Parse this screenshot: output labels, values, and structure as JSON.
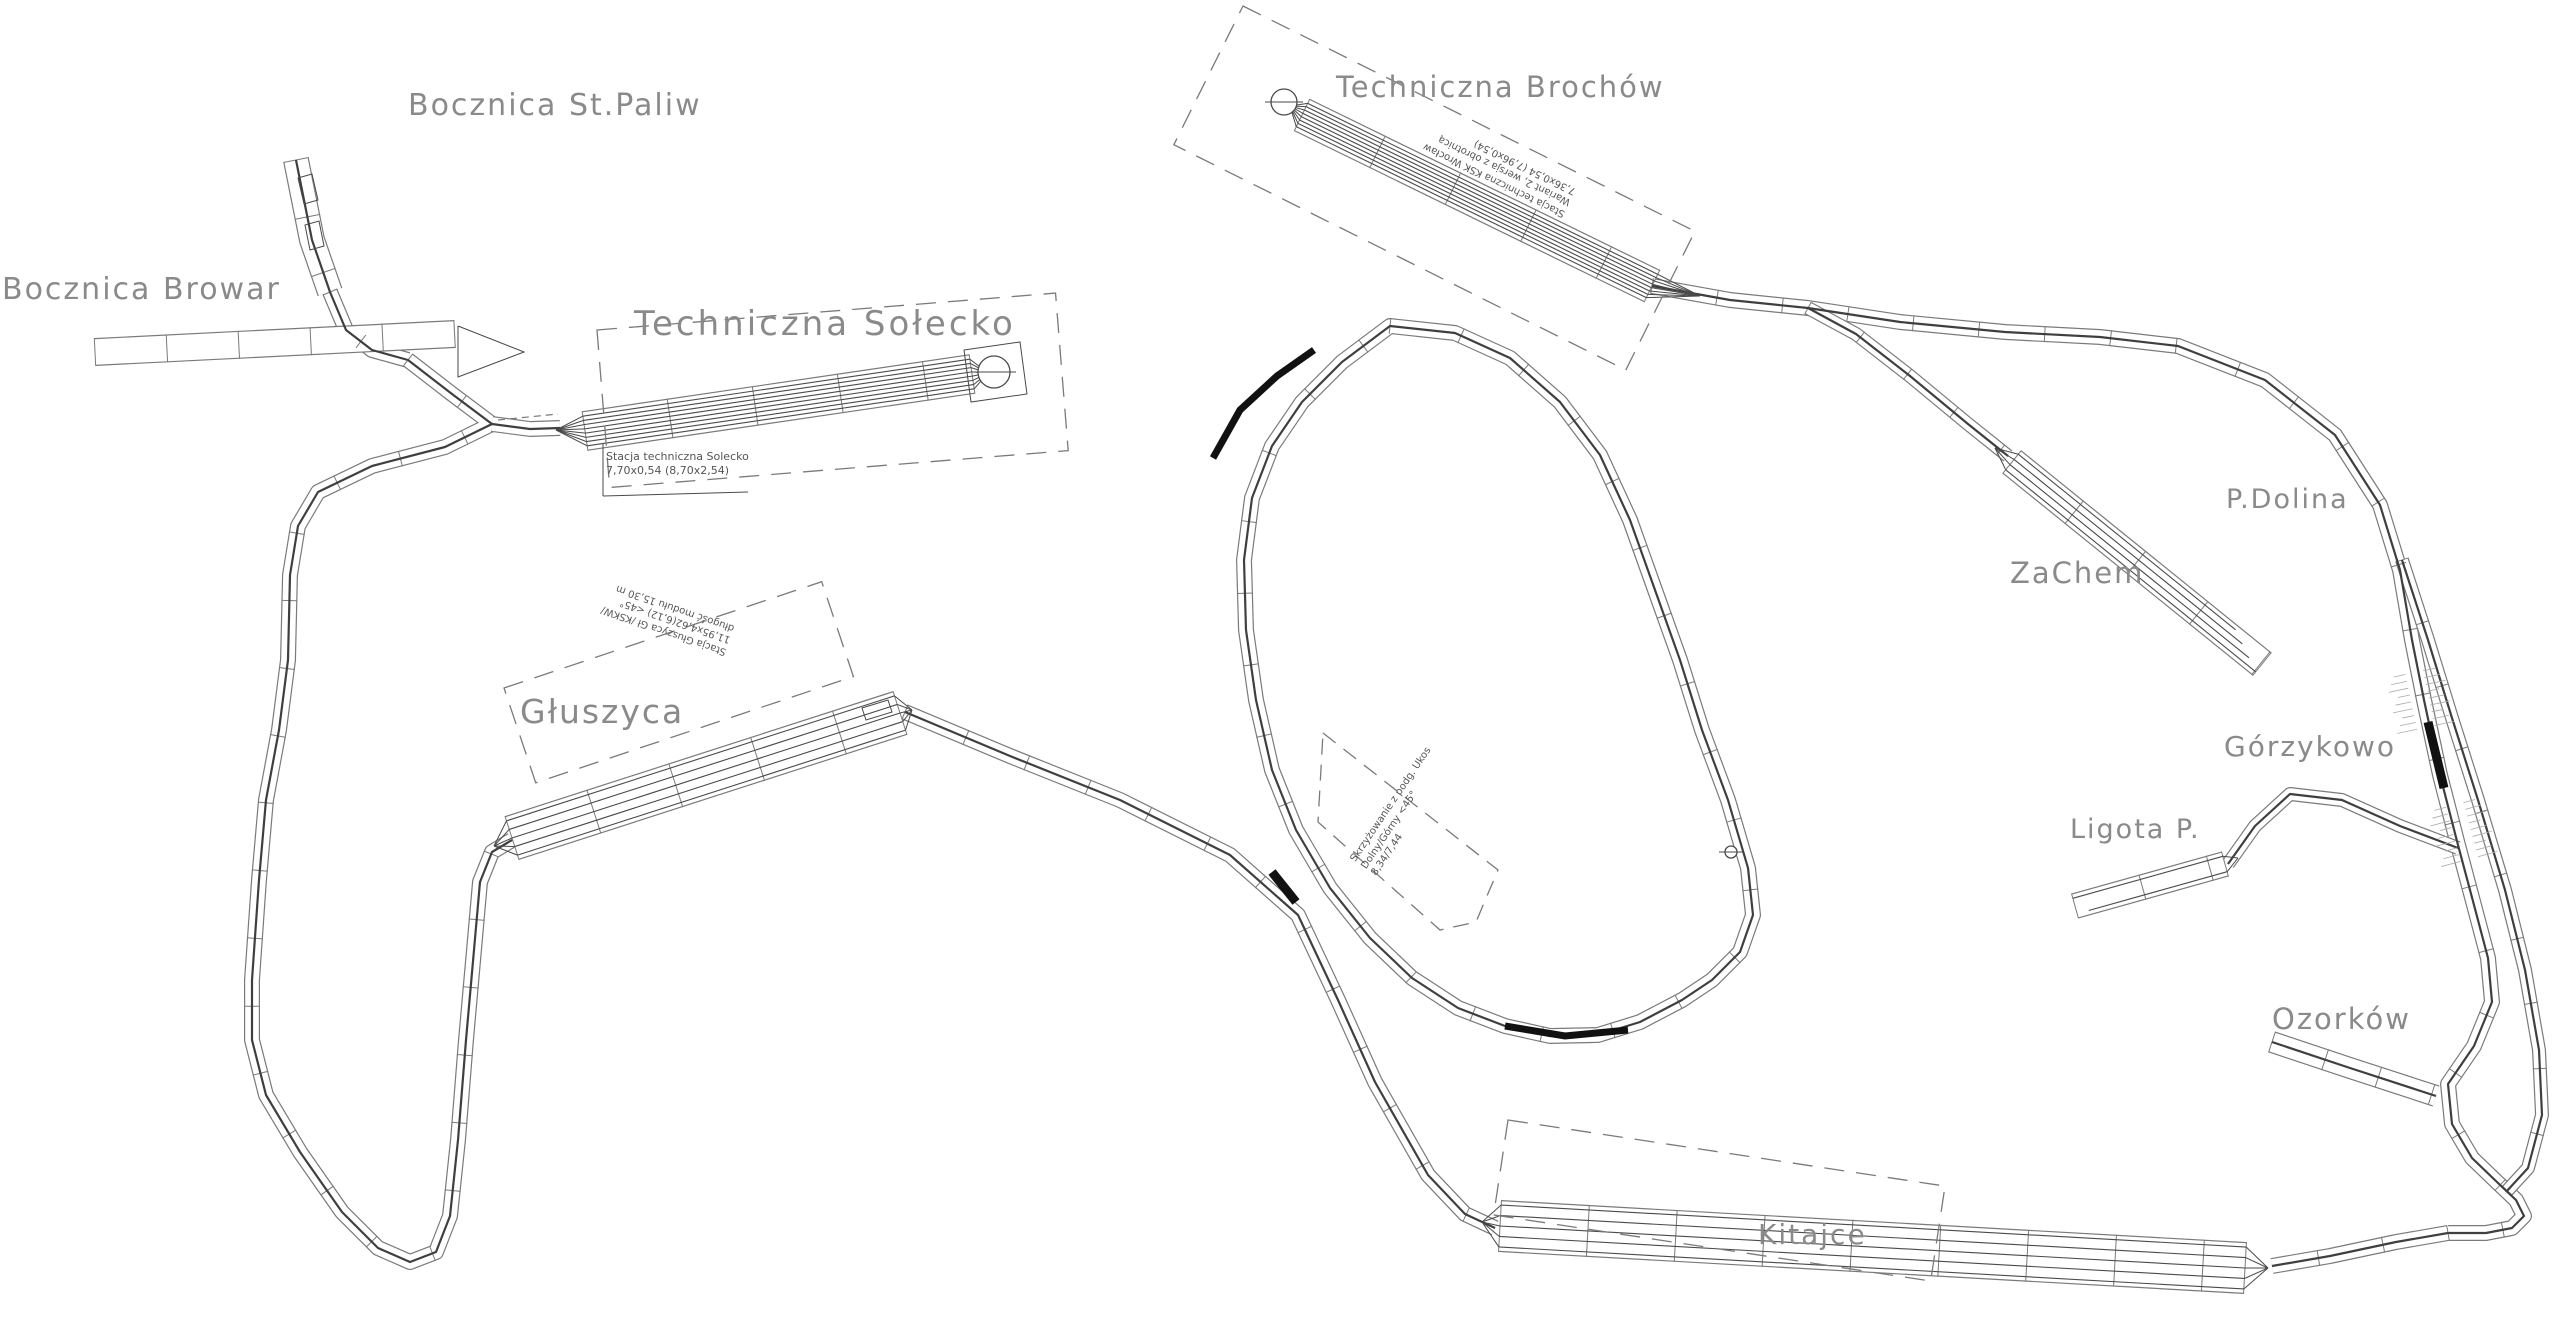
{
  "page": {
    "background": "#ffffff"
  },
  "colors": {
    "track_ink": "#3f3f3f",
    "module_outline": "#7a7a7a",
    "yard_track": "#4a4a4a",
    "label": "#8a8a8a",
    "caption": "#555555",
    "tunnel": "#111111",
    "hatch": "#aaaaaa"
  },
  "stations": {
    "bocznica_st_paliw": {
      "label": "Bocznica St.Paliw"
    },
    "bocznica_browar": {
      "label": "Bocznica Browar"
    },
    "techniczna_solecko": {
      "label": "Techniczna Sołecko",
      "note_lines": [
        "Stacja techniczna Solecko",
        "7,70x0,54 (8,70x2,54)"
      ]
    },
    "techniczna_brochow": {
      "label": "Techniczna Brochów",
      "note_lines": [
        "Stacja techniczna KSK Wrocław",
        "Wariant 2, wersja z obrotnicą",
        "7,36x0,54 (7,96x0,54)"
      ]
    },
    "gluszyca": {
      "label": "Głuszyca",
      "note_lines": [
        "Stacja Głuszyca Gł /KSKW/",
        "11,95x4,62(6,12) <45°",
        "długość modułu 15,30 m"
      ]
    },
    "zachem": {
      "label": "ZaChem"
    },
    "p_dolina": {
      "label": "P.Dolina"
    },
    "gorzykowo": {
      "label": "Górzykowo"
    },
    "ligota_p": {
      "label": "Ligota P."
    },
    "ozorkow": {
      "label": "Ozorków"
    },
    "kitajce": {
      "label": "Kitajce"
    }
  },
  "junction_note": {
    "lines": [
      "Skrzyżowanie z podg. Ukos",
      "Dolny/Górny <45°",
      "8,34/7,44"
    ]
  }
}
